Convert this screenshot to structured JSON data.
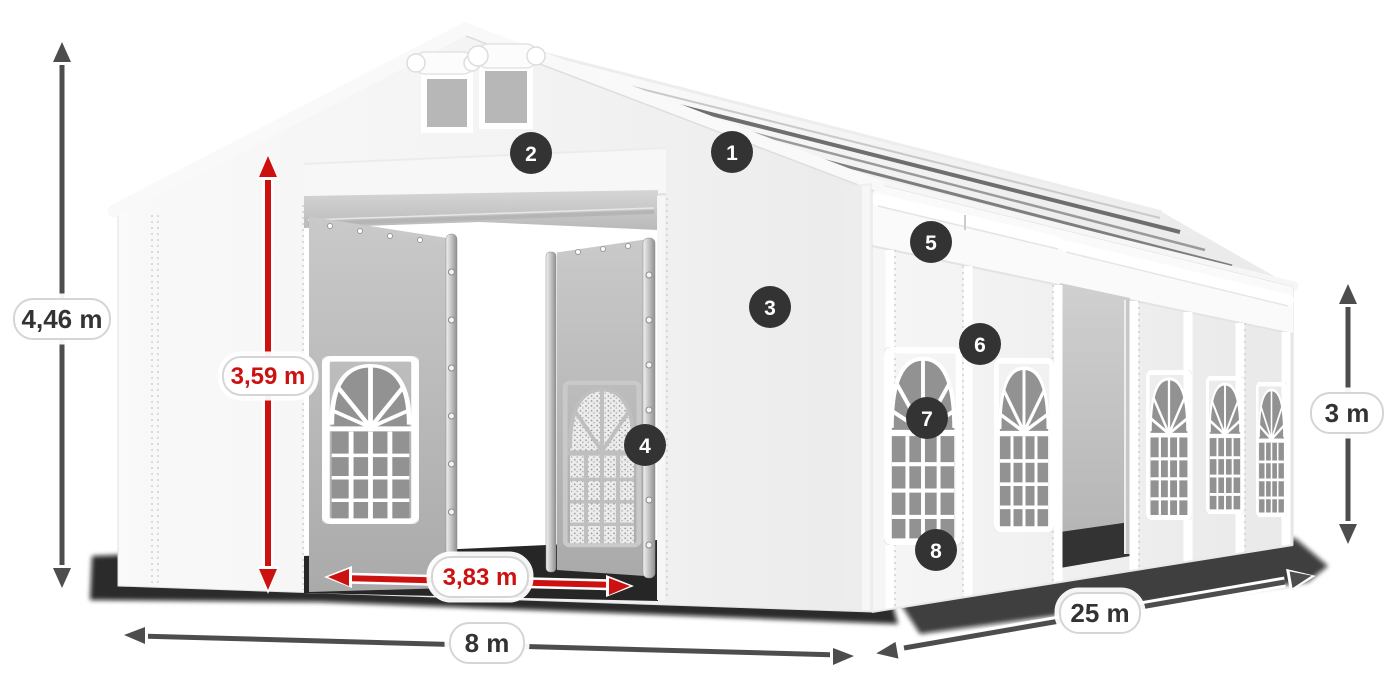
{
  "diagram": {
    "type": "tent-dimension-diagram",
    "dimensions": {
      "total_height": "4,46 m",
      "entrance_height": "3,59 m",
      "entrance_width": "3,83 m",
      "front_width": "8 m",
      "side_length": "25 m",
      "side_height": "3 m"
    },
    "callouts": [
      {
        "number": "1"
      },
      {
        "number": "2"
      },
      {
        "number": "3"
      },
      {
        "number": "4"
      },
      {
        "number": "5"
      },
      {
        "number": "6"
      },
      {
        "number": "7"
      },
      {
        "number": "8"
      }
    ],
    "colors": {
      "accent_red": "#cc1111",
      "arrow_gray": "#4d4d4d",
      "badge_bg": "#333333",
      "fabric_white": "#f5f5f5",
      "window_gray": "#8f8f8f",
      "shadow_black": "#0a0a0a"
    }
  }
}
